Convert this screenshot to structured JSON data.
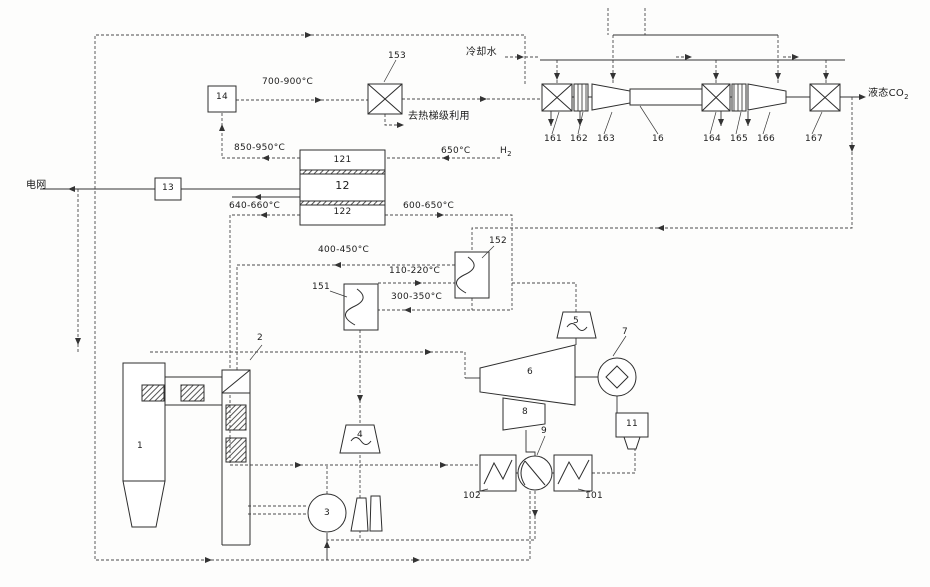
{
  "diagram": {
    "streams": {
      "grid": "电网",
      "cooling_water": "冷却水",
      "liquid_co2_main": "液态CO",
      "liquid_co2_sub": "2",
      "heat_cascade": "去热梯级利用",
      "h2_main": "H",
      "h2_sub": "2"
    },
    "temperatures": {
      "t700_900": "700-900°C",
      "t850_950": "850-950°C",
      "t650": "650°C",
      "t640_660": "640-660°C",
      "t600_650": "600-650°C",
      "t400_450": "400-450°C",
      "t110_220": "110-220°C",
      "t300_350": "300-350°C"
    },
    "components": {
      "c1": "1",
      "c2": "2",
      "c3": "3",
      "c4": "4",
      "c5": "5",
      "c6": "6",
      "c7": "7",
      "c8": "8",
      "c9": "9",
      "c11": "11",
      "c12": "12",
      "c121": "121",
      "c122": "122",
      "c13": "13",
      "c14": "14",
      "c16": "16",
      "c101": "101",
      "c102": "102",
      "c151": "151",
      "c152": "152",
      "c153": "153",
      "c161": "161",
      "c162": "162",
      "c163": "163",
      "c164": "164",
      "c165": "165",
      "c166": "166",
      "c167": "167"
    }
  }
}
